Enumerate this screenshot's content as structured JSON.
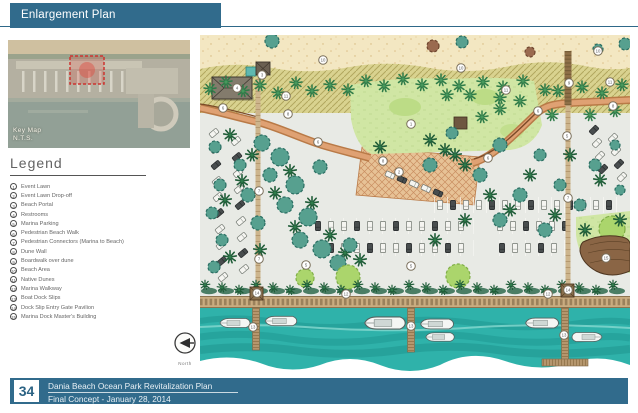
{
  "header": {
    "title": "Enlargement Plan",
    "accent_color": "#316b8c"
  },
  "key_map": {
    "caption_line1": "Key Map",
    "caption_line2": "N.T.S."
  },
  "legend": {
    "title": "Legend",
    "items": [
      {
        "n": "1",
        "label": "Event Lawn"
      },
      {
        "n": "2",
        "label": "Event Lawn Drop-off"
      },
      {
        "n": "3",
        "label": "Beach Portal"
      },
      {
        "n": "4",
        "label": "Restrooms"
      },
      {
        "n": "5",
        "label": "Marina Parking"
      },
      {
        "n": "6",
        "label": "Pedestrian Beach Walk"
      },
      {
        "n": "7",
        "label": "Pedestrian Connectors (Marina to Beach)"
      },
      {
        "n": "8",
        "label": "Dune Wall"
      },
      {
        "n": "9",
        "label": "Boardwalk over dune"
      },
      {
        "n": "10",
        "label": "Beach Area"
      },
      {
        "n": "11",
        "label": "Native Dunes"
      },
      {
        "n": "12",
        "label": "Marina Walkway"
      },
      {
        "n": "13",
        "label": "Boat Dock Slips"
      },
      {
        "n": "14",
        "label": "Dock Slip Entry Gate Pavilion"
      },
      {
        "n": "15",
        "label": "Marina Dock Master's Building"
      }
    ]
  },
  "map": {
    "north_label": "North",
    "markers": [
      {
        "n": "1",
        "x": 211,
        "y": 89
      },
      {
        "n": "2",
        "x": 199,
        "y": 137
      },
      {
        "n": "3",
        "x": 62,
        "y": 40
      },
      {
        "n": "4",
        "x": 37,
        "y": 53
      },
      {
        "n": "5",
        "x": 367,
        "y": 101
      },
      {
        "n": "5",
        "x": 106,
        "y": 230
      },
      {
        "n": "5",
        "x": 211,
        "y": 231
      },
      {
        "n": "6",
        "x": 23,
        "y": 73
      },
      {
        "n": "6",
        "x": 118,
        "y": 107
      },
      {
        "n": "6",
        "x": 288,
        "y": 123
      },
      {
        "n": "6",
        "x": 338,
        "y": 76
      },
      {
        "n": "7",
        "x": 59,
        "y": 156
      },
      {
        "n": "7",
        "x": 59,
        "y": 224
      },
      {
        "n": "7",
        "x": 368,
        "y": 163
      },
      {
        "n": "8",
        "x": 88,
        "y": 79
      },
      {
        "n": "8",
        "x": 413,
        "y": 71
      },
      {
        "n": "8",
        "x": 183,
        "y": 126
      },
      {
        "n": "9",
        "x": 369,
        "y": 48
      },
      {
        "n": "10",
        "x": 123,
        "y": 25
      },
      {
        "n": "10",
        "x": 261,
        "y": 33
      },
      {
        "n": "10",
        "x": 398,
        "y": 16
      },
      {
        "n": "11",
        "x": 86,
        "y": 61
      },
      {
        "n": "11",
        "x": 306,
        "y": 55
      },
      {
        "n": "11",
        "x": 410,
        "y": 47
      },
      {
        "n": "12",
        "x": 146,
        "y": 259
      },
      {
        "n": "12",
        "x": 348,
        "y": 259
      },
      {
        "n": "13",
        "x": 53,
        "y": 292
      },
      {
        "n": "13",
        "x": 211,
        "y": 291
      },
      {
        "n": "13",
        "x": 364,
        "y": 300
      },
      {
        "n": "14",
        "x": 57,
        "y": 258
      },
      {
        "n": "14",
        "x": 368,
        "y": 255
      },
      {
        "n": "15",
        "x": 406,
        "y": 223
      }
    ]
  },
  "footer": {
    "page_number": "34",
    "line1": "Dania Beach Ocean Park Revitalization Plan",
    "line2": "Final Concept - January 28, 2014"
  }
}
